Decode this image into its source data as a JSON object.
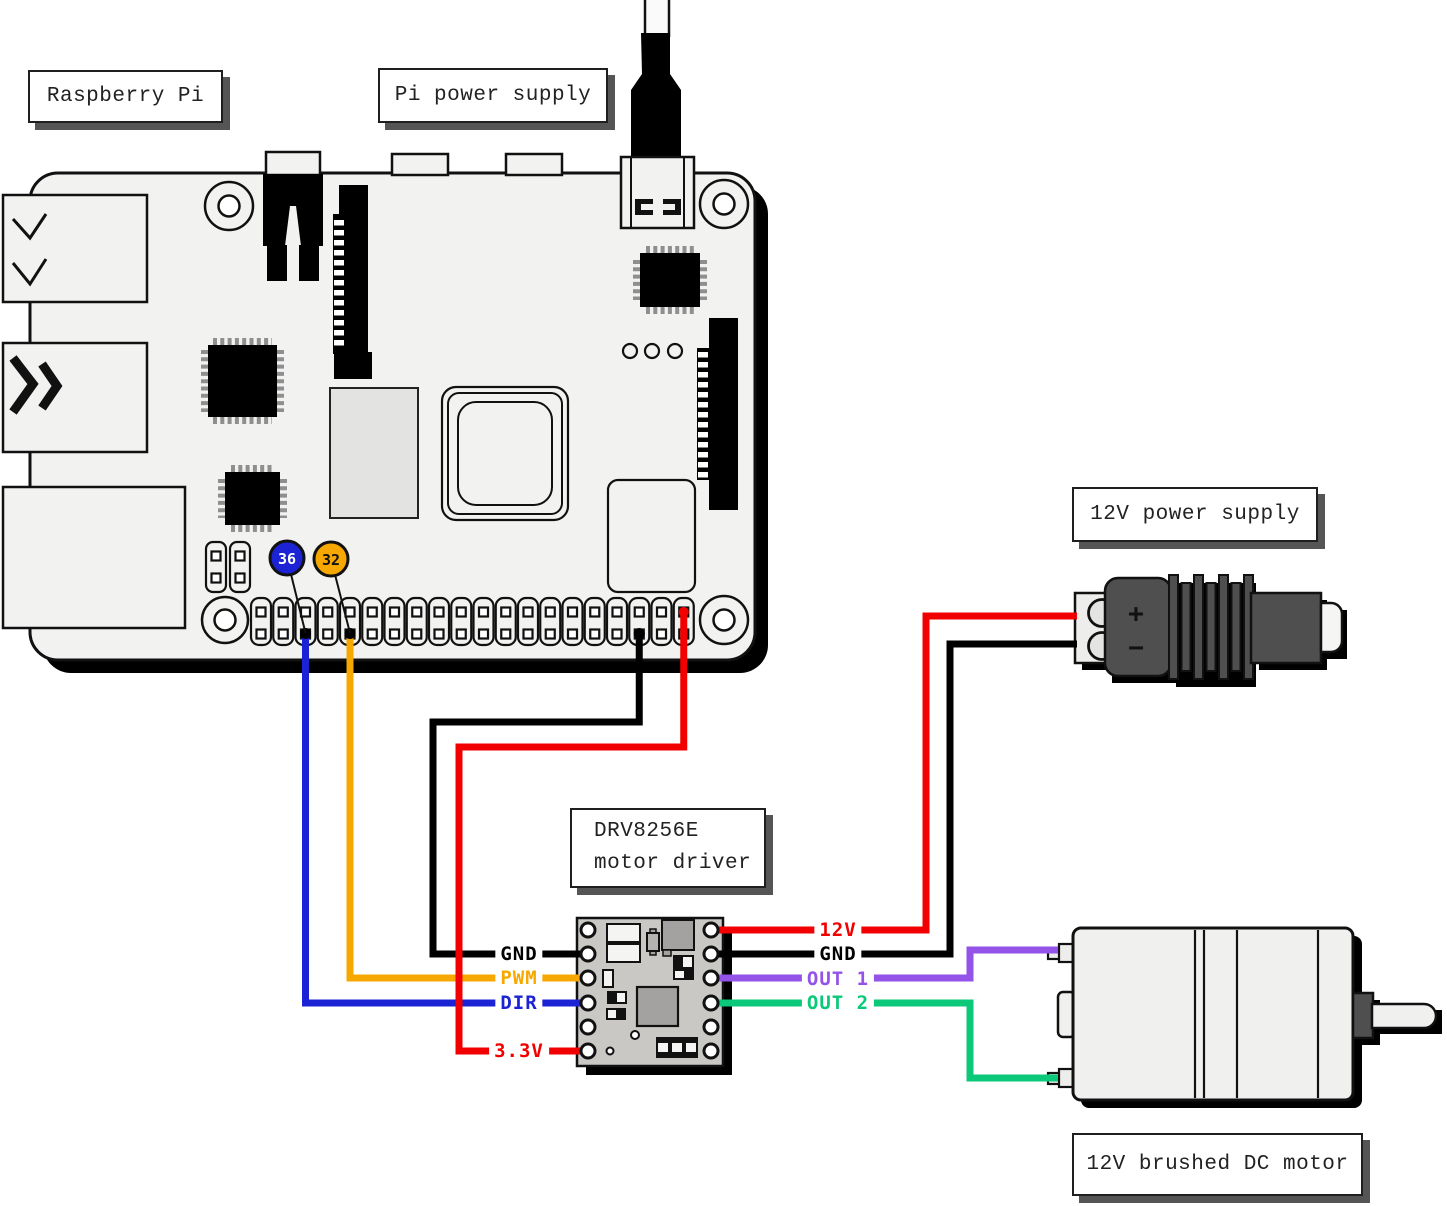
{
  "callouts": {
    "raspberry_pi": "Raspberry Pi",
    "pi_power_supply": "Pi power supply",
    "supply_12v": "12V power supply",
    "motor_driver_line1": "DRV8256E",
    "motor_driver_line2": "motor driver",
    "dc_motor": "12V brushed DC motor"
  },
  "gpio_badges": [
    {
      "pin": "36",
      "color": "#1b23d4",
      "text_color": "#ffffff"
    },
    {
      "pin": "32",
      "color": "#f7a800",
      "text_color": "#111111"
    }
  ],
  "driver": {
    "pins_left": [
      {
        "label": "GND",
        "color": "#000000"
      },
      {
        "label": "PWM",
        "color": "#f7a800"
      },
      {
        "label": "DIR",
        "color": "#1b23d4"
      },
      {
        "label": "3.3V",
        "color": "#f20000"
      }
    ],
    "pins_right": [
      {
        "label": "12V",
        "color": "#f20000"
      },
      {
        "label": "GND",
        "color": "#000000"
      },
      {
        "label": "OUT 1",
        "color": "#9353e8"
      },
      {
        "label": "OUT 2",
        "color": "#0bc978"
      }
    ]
  },
  "power_terminal": {
    "plus": "+",
    "minus": "−"
  },
  "wire_colors": {
    "blue": "#1b23d4",
    "orange": "#f7a800",
    "red": "#f20000",
    "black": "#000000",
    "purple": "#9353e8",
    "green": "#0bc978"
  }
}
